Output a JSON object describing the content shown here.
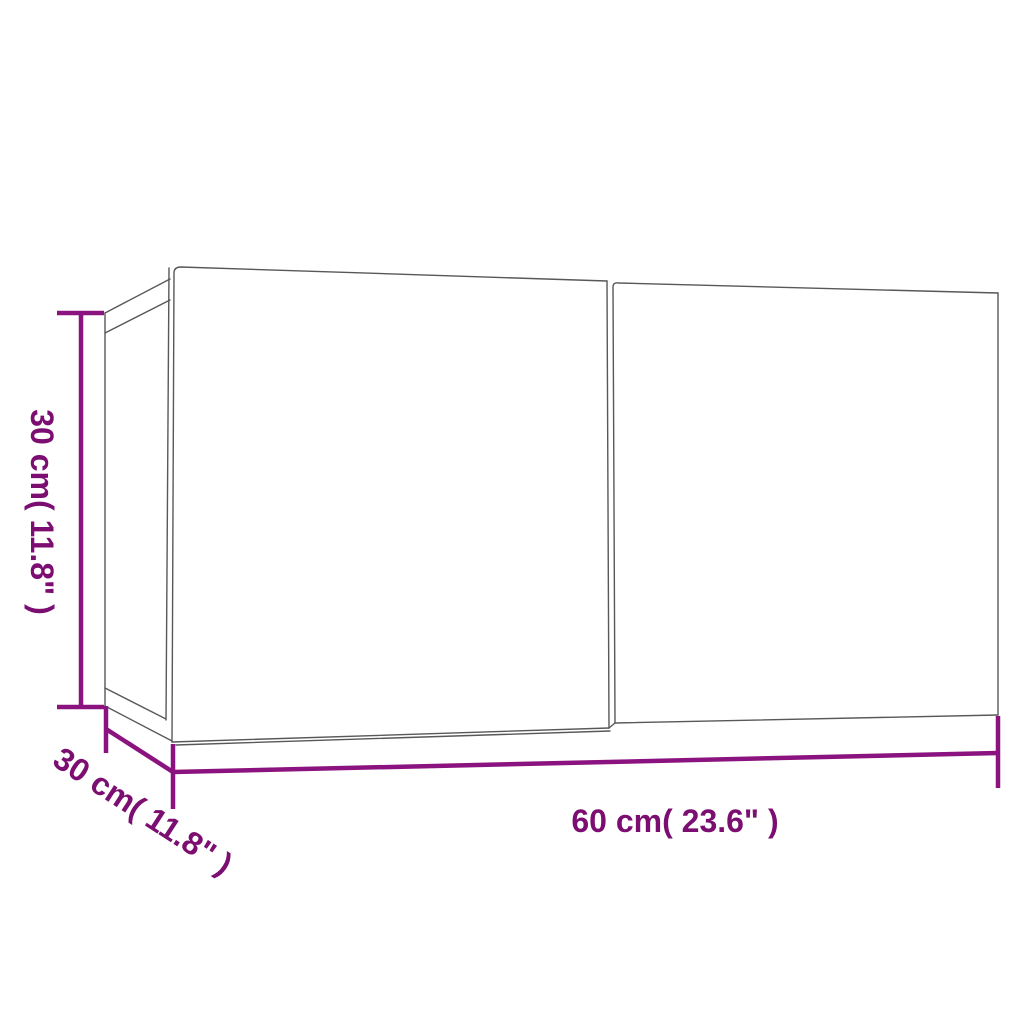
{
  "diagram": {
    "description": "wall-mounted two-door TV cabinet dimension drawing",
    "labels": {
      "height": "30 cm( 11.8\" )",
      "depth": "30 cm( 11.8\" )",
      "width": "60 cm( 23.6\" )"
    }
  },
  "colors": {
    "dimension-line": "#8B1380",
    "dimension-text": "#7C0E71",
    "outline": "#585858",
    "background": "#ffffff"
  }
}
